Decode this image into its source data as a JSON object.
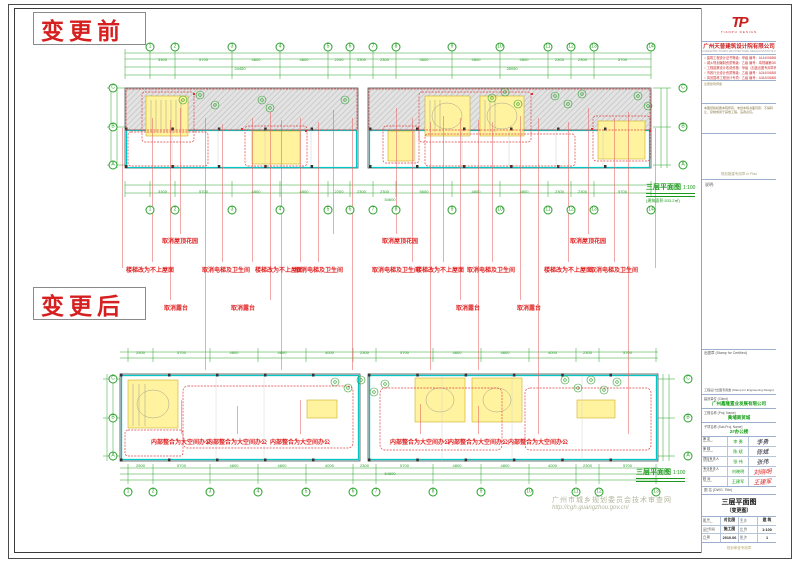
{
  "sheet": {
    "label_before": "变更前",
    "label_after": "变更后",
    "watermark_line1": "广州市城乡规划委员会技术审查网",
    "watermark_line2": "http://cgh.guangzhou.gov.cn/"
  },
  "plans": {
    "before": {
      "title": "三层平面图",
      "scale": "1:100",
      "area": "(建筑面积:533.2㎡)"
    },
    "after": {
      "title": "三层平面图",
      "scale": "1:100"
    }
  },
  "colors": {
    "cad_green": "#2aa02a",
    "wall_cyan": "#00c6c6",
    "revision_red": "#e02525",
    "room_yellow": "#fff3a0"
  },
  "drawing": {
    "red_notes": [
      {
        "t": "取消屋顶花园",
        "x": 180,
        "y": 236
      },
      {
        "t": "取消屋顶花园",
        "x": 400,
        "y": 236
      },
      {
        "t": "取消屋顶花园",
        "x": 588,
        "y": 236
      },
      {
        "t": "楼梯改为不上屋面",
        "x": 150,
        "y": 265
      },
      {
        "t": "取消电梯及卫生间",
        "x": 226,
        "y": 265
      },
      {
        "t": "楼梯改为不上屋面",
        "x": 279,
        "y": 265
      },
      {
        "t": "取消电梯及卫生间",
        "x": 319,
        "y": 265
      },
      {
        "t": "取消电梯及卫生间",
        "x": 396,
        "y": 265
      },
      {
        "t": "楼梯改为不上屋面",
        "x": 440,
        "y": 265
      },
      {
        "t": "取消电梯及卫生间",
        "x": 491,
        "y": 265
      },
      {
        "t": "楼梯改为不上屋面",
        "x": 568,
        "y": 265
      },
      {
        "t": "取消电梯及卫生间",
        "x": 614,
        "y": 265
      },
      {
        "t": "取消露台",
        "x": 176,
        "y": 303
      },
      {
        "t": "取消露台",
        "x": 243,
        "y": 303
      },
      {
        "t": "取消露台",
        "x": 468,
        "y": 303
      },
      {
        "t": "取消露台",
        "x": 529,
        "y": 303
      },
      {
        "t": "内部整合为大空间办公",
        "x": 181,
        "y": 437
      },
      {
        "t": "内部整合为大空间办公",
        "x": 237,
        "y": 437
      },
      {
        "t": "内部整合为大空间办公",
        "x": 300,
        "y": 437
      },
      {
        "t": "内部整合为大空间办公",
        "x": 420,
        "y": 437
      },
      {
        "t": "内部整合为大空间办公",
        "x": 478,
        "y": 437
      },
      {
        "t": "内部整合为大空间办公",
        "x": 538,
        "y": 437
      }
    ],
    "leaders": [
      [
        122,
        128,
        268
      ],
      [
        152,
        118,
        262
      ],
      [
        170,
        120,
        300
      ],
      [
        180,
        108,
        234
      ],
      [
        205,
        118,
        370
      ],
      [
        222,
        124,
        262
      ],
      [
        252,
        118,
        262
      ],
      [
        270,
        112,
        300
      ],
      [
        281,
        120,
        370
      ],
      [
        300,
        118,
        262
      ],
      [
        318,
        122,
        262
      ],
      [
        333,
        110,
        234
      ],
      [
        352,
        118,
        370
      ],
      [
        396,
        108,
        234
      ],
      [
        412,
        118,
        262
      ],
      [
        430,
        122,
        370
      ],
      [
        443,
        116,
        262
      ],
      [
        460,
        118,
        300
      ],
      [
        478,
        120,
        370
      ],
      [
        492,
        122,
        262
      ],
      [
        520,
        116,
        300
      ],
      [
        538,
        118,
        434
      ],
      [
        568,
        122,
        262
      ],
      [
        588,
        108,
        234
      ],
      [
        614,
        118,
        262
      ],
      [
        628,
        112,
        434
      ],
      [
        655,
        128,
        268
      ],
      [
        181,
        400,
        434
      ],
      [
        237,
        406,
        434
      ],
      [
        300,
        400,
        434
      ],
      [
        420,
        404,
        434
      ],
      [
        478,
        406,
        434
      ]
    ],
    "grids": {
      "before_top": {
        "y": 47,
        "xs": [
          150,
          175,
          232,
          280,
          328,
          350,
          373,
          396,
          452,
          500,
          548,
          571,
          594,
          651
        ],
        "labels": [
          "1",
          "2",
          "3",
          "4",
          "5",
          "6",
          "7",
          "8",
          "9",
          "10",
          "11",
          "12",
          "13",
          "14"
        ]
      },
      "before_bottom": {
        "y": 210,
        "xs": [
          150,
          175,
          232,
          280,
          328,
          350,
          373,
          396,
          452,
          500,
          548,
          571,
          594,
          651
        ],
        "labels": [
          "1",
          "2",
          "3",
          "4",
          "5",
          "6",
          "7",
          "8",
          "9",
          "10",
          "11",
          "12",
          "13",
          "14"
        ]
      },
      "after_bottom": {
        "y": 492,
        "xs": [
          128,
          153,
          210,
          258,
          306,
          353,
          376,
          433,
          481,
          529,
          576,
          599,
          656
        ],
        "labels": [
          "1",
          "2",
          "3",
          "4",
          "5",
          "6",
          "7",
          "8",
          "9",
          "10",
          "11",
          "12",
          "13"
        ]
      },
      "before_left": {
        "x": 113,
        "ys": [
          88,
          127,
          165
        ],
        "labels": [
          "C",
          "B",
          "A"
        ]
      },
      "before_right": {
        "x": 683,
        "ys": [
          88,
          127,
          165
        ],
        "labels": [
          "C",
          "B",
          "A"
        ]
      },
      "after_left": {
        "x": 113,
        "ys": [
          379,
          418,
          456
        ],
        "labels": [
          "C",
          "B",
          "A"
        ]
      },
      "after_right": {
        "x": 688,
        "ys": [
          379,
          418,
          456
        ],
        "labels": [
          "C",
          "B",
          "A"
        ]
      }
    },
    "dim_rows": [
      {
        "grid": "before_top",
        "y": 57,
        "values": [
          "3300",
          "5700",
          "4800",
          "4800",
          "2200",
          "2300",
          "2300",
          "5600",
          "4800",
          "4800",
          "2300",
          "2300",
          "5700"
        ]
      },
      {
        "grid": "before_bottom",
        "y": 189,
        "values": [
          "3300",
          "5700",
          "4800",
          "4800",
          "2200",
          "2300",
          "2300",
          "5600",
          "4800",
          "4800",
          "2300",
          "2300",
          "5700"
        ]
      },
      {
        "grid": "after_bottom",
        "y": 350,
        "values": [
          "2500",
          "5700",
          "4800",
          "4800",
          "4000",
          "2300",
          "5700",
          "4800",
          "4800",
          "4000",
          "2300",
          "5700"
        ]
      },
      {
        "grid": "after_bottom",
        "y": 463,
        "values": [
          "2500",
          "5700",
          "4800",
          "4800",
          "4000",
          "2300",
          "5700",
          "4800",
          "4800",
          "4000",
          "2300",
          "5700"
        ]
      }
    ],
    "dim_totals": [
      {
        "t": "24450",
        "x": 240,
        "y": 66
      },
      {
        "t": "28050",
        "x": 512,
        "y": 66
      },
      {
        "t": "54600",
        "x": 390,
        "y": 197
      },
      {
        "t": "54600",
        "x": 390,
        "y": 471
      }
    ]
  },
  "titleblock": {
    "logo": "TP",
    "logo_sub": "TIANPU DESIGN",
    "company": "广州天普建筑设计院有限公司",
    "company_en": "GUANGZHOU TIANPU ARCHITECTURAL DESIGN INSTITUTE CO.,LTD.",
    "certs": [
      "建筑工程设计证书等级：甲级 编号：A144006888",
      "城乡规划编制资质等级：乙级 编号：粤规编第081234",
      "工程勘察设计收费资格：甲级（加盖出图专用章有效）",
      "市政行业设计资质等级：乙级 编号：A244006888",
      "风景园林工程设计专项：乙级 编号：A344006888"
    ],
    "boxA_label": "注册建筑师章",
    "disclaimer": "本图纸版权属本院所有，未经本院书面同意，不得转让、复制或用于其他工程，违者必究。",
    "plan_stamp": "规划报建专用章 In Plan",
    "notes_label": "说明:",
    "stamp_certified": "出图章 (Stamp for Certified)",
    "stamp_engineering": "工程设计出图专用章 (Stamp for Engineering Design)",
    "client_label": "建设单位 (Client)",
    "client": "广州鑫隆置业发展有限公司",
    "project_label": "工程名称 (Proj. Name)",
    "project": "黄埔商贸城",
    "subproj_label": "子项名称 (Sub-Proj. Name)",
    "subproj": "2#办公楼",
    "signers": [
      {
        "role": "审 定",
        "en": "Approved",
        "name": "李 勇",
        "sig": "李勇"
      },
      {
        "role": "审 核",
        "en": "Examined",
        "name": "陈 斌",
        "sig": "陈斌"
      },
      {
        "role": "项目负责人",
        "en": "Proj. Archt.",
        "name": "张 伟",
        "sig": "张伟"
      },
      {
        "role": "专业负责人",
        "en": "Disc. Chief",
        "name": "刘晓明",
        "sig": "刘晓明"
      },
      {
        "role": "校 对",
        "en": "Checked",
        "name": "王建军",
        "sig": "王建军"
      },
      {
        "role": "设 计",
        "en": "Designed",
        "name": "赵 成",
        "sig": "赵成"
      }
    ],
    "dwg_label": "图 名 (DWG. Title)",
    "dwg_title": "三层平面图",
    "dwg_title_sub": "（变更图）",
    "meta": [
      {
        "l1": "图 号",
        "e1": "DWG. No.",
        "v1": "对比图",
        "l2": "专 业",
        "e2": "Spec.",
        "v2": "建 筑"
      },
      {
        "l1": "设计阶段",
        "e1": "Stage",
        "v1": "施工图",
        "l2": "比 例",
        "e2": "Scale",
        "v2": "1:100"
      },
      {
        "l1": "日 期",
        "e1": "Date",
        "v1": "2010.06",
        "l2": "版 次",
        "e2": "Issue",
        "v2": "1"
      }
    ],
    "footer": "规划审查专用章"
  }
}
